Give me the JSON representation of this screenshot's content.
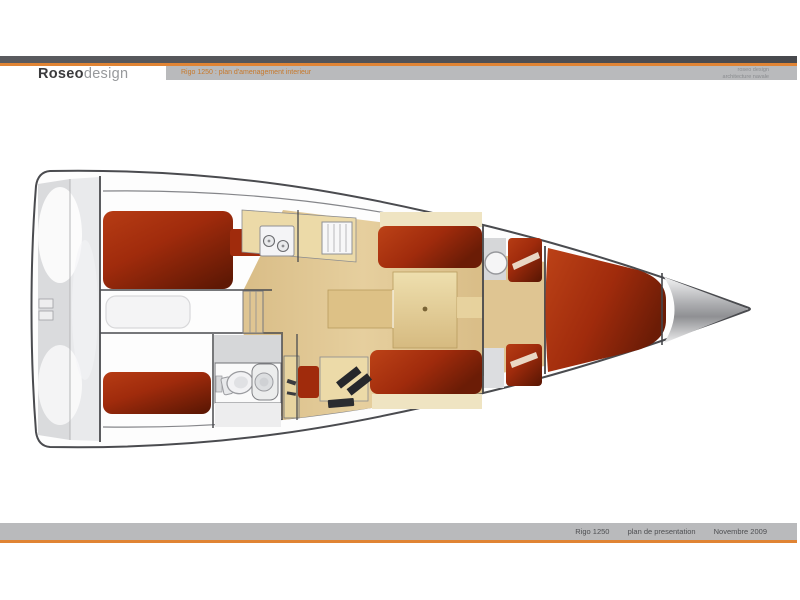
{
  "header": {
    "brand_bold": "Roseo",
    "brand_light": "design",
    "annotation": "Rigo 1250 : plan d'amenagement interieur",
    "note_line1": "roseo design",
    "note_line2": "architecture navale"
  },
  "footer": {
    "project": "Rigo 1250",
    "doc_label": "plan de presentation",
    "date": "Novembre 2009"
  },
  "drawing": {
    "subject": "sailboat-interior-layout-top-view",
    "areas": [
      "transom-locker",
      "port-aft-berth",
      "starboard-aft-berth",
      "engine-hatch",
      "companionway-steps",
      "head-toilet",
      "head-sink",
      "galley-stove",
      "galley-sink",
      "salon-sole",
      "salon-table",
      "port-settee",
      "starboard-settee",
      "nav-station",
      "forward-v-berth",
      "anchor-locker"
    ],
    "colors": {
      "accent_orange": "#e08434",
      "bar_gray": "#b9babc",
      "hull_outline": "#4a4b4f",
      "deck_gray": "#dadbdd",
      "deck_gray_light": "#e9eaec",
      "berth_red_light": "#b63c14",
      "berth_red": "#a02b0c",
      "berth_red_dark": "#5f1804",
      "sole_tan": "#dfc592",
      "counter_beige": "#ecdaa8",
      "table_beige": "#e5cf9c",
      "panel_gray": "#d6d7d9",
      "fixture_white": "#f2f2f4",
      "instrument_black": "#26272b"
    }
  }
}
